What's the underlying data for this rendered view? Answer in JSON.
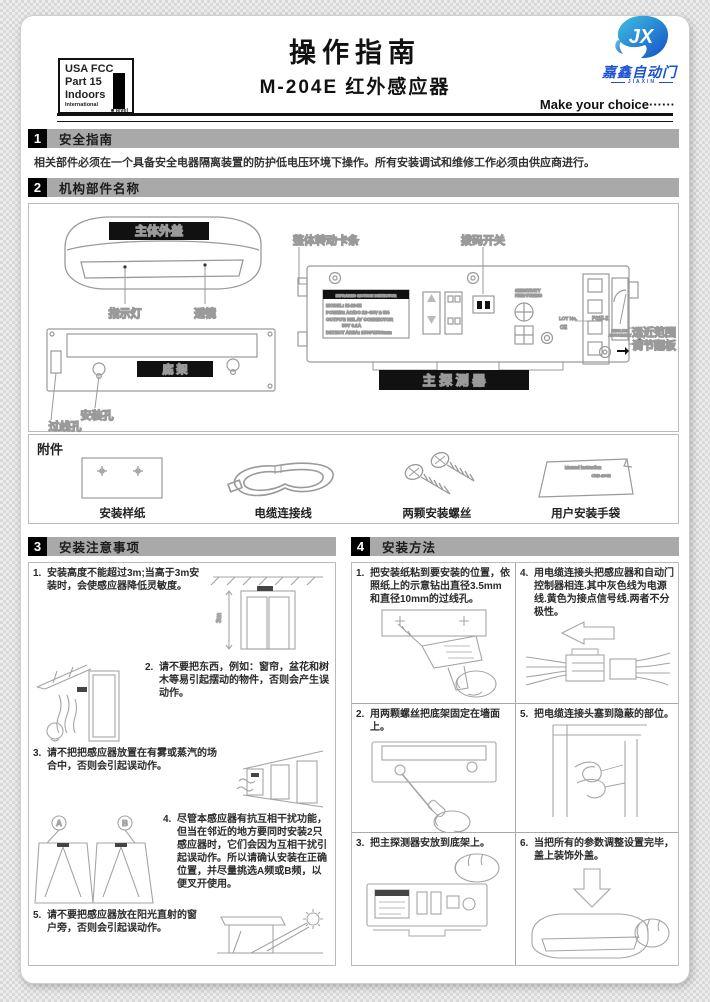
{
  "page": {
    "title": "操作指南",
    "subtitle": "M-204E 红外感应器",
    "tagline": "Make  your choice······"
  },
  "fcc": {
    "line1": "USA FCC",
    "line2": "Part 15",
    "line3": "Indoors",
    "intl": "International",
    "level": "■ level"
  },
  "brand": {
    "logo_text": "JX",
    "name": "嘉鑫自动门",
    "sub": "JIAXIN",
    "blue": "#1a50d2",
    "teal": "#35aede"
  },
  "sections": {
    "s1": {
      "num": "1",
      "title": "安全指南",
      "body": "相关部件必须在一个具备安全电器隔离装置的防护低电压环境下操作。所有安装调试和维修工作必须由供应商进行。"
    },
    "s2": {
      "num": "2",
      "title": "机构部件名称"
    },
    "s3": {
      "num": "3",
      "title": "安装注意事项"
    },
    "s4": {
      "num": "4",
      "title": "安装方法"
    }
  },
  "diagram": {
    "cover_label": "主体外盖",
    "indicator": "指示灯",
    "lens": "透镜",
    "base_label": "底  架",
    "mount_hole": "安装孔",
    "wire_hole": "过线孔",
    "clip_bar": "整体转动卡条",
    "dip_switch": "拨码开关",
    "flap_line1": "远近范围",
    "flap_line2": "调节翻板",
    "main_label": "主 探 测 器",
    "plate": {
      "header": "INFRARED MOTION DETECTOR",
      "l1": "MODEL: M-204E",
      "l2": "POWER: AC/DC 12~36V ± 5%",
      "l3": "OUTPUT: RELAY CONNECTOR",
      "l4": "50V 0.1A",
      "l5": "DETECT AREA: 1500*1500mm"
    },
    "sens1": "SENSITIVITY",
    "sens2": "FINE-TUNING",
    "lot": "LOT No.",
    "pn": "P015-2",
    "ce": "CE",
    "nf1": "NEAR-FAR",
    "nf2": "ADJUSTMENT"
  },
  "accessories": {
    "title": "附件",
    "items": [
      {
        "caption": "安装样纸"
      },
      {
        "caption": "电缆连接线"
      },
      {
        "caption": "两颗安装螺丝"
      },
      {
        "caption": "用户安装手袋"
      }
    ],
    "manual1": "Manual instruction",
    "manual2": "CNB-204E"
  },
  "notes": [
    {
      "num": "1.",
      "text": "安装高度不能超过3m;当高于3m安装时，会使感应器降低灵敏度。"
    },
    {
      "num": "2.",
      "text": "请不要把东西，例如：窗帘，盆花和树木等易引起摆动的物件，否则会产生误动作。"
    },
    {
      "num": "3.",
      "text": "请不把把感应器放置在有雾或蒸汽的场合中，否则会引起误动作。"
    },
    {
      "num": "4.",
      "text": "尽管本感应器有抗互相干扰功能，但当在邻近的地方要同时安装2只感应器时，它们会因为互相干扰引起误动作。所以请确认安装在正确位置，并尽量挑选A频或B频，以便叉开使用。"
    },
    {
      "num": "5.",
      "text": "请不要把感应器放在阳光直射的窗户旁，否则会引起误动作。"
    }
  ],
  "note_marks": {
    "height": "3m",
    "a": "A",
    "b": "B"
  },
  "steps": [
    {
      "num": "1.",
      "text": "把安装纸粘到要安装的位置，依照纸上的示意钻出直径3.5mm和直径10mm的过线孔。"
    },
    {
      "num": "2.",
      "text": "用两颗螺丝把底架固定在墙面上。"
    },
    {
      "num": "3.",
      "text": "把主探测器安放到底架上。"
    },
    {
      "num": "4.",
      "text": "用电缆连接头把感应器和自动门控制器相连.其中灰色线为电源线.黄色为接点信号线.两者不分极性。"
    },
    {
      "num": "5.",
      "text": "把电缆连接头塞到隐蔽的部位。"
    },
    {
      "num": "6.",
      "text": "当把所有的参数调整设置完毕，盖上装饰外盖。"
    }
  ]
}
